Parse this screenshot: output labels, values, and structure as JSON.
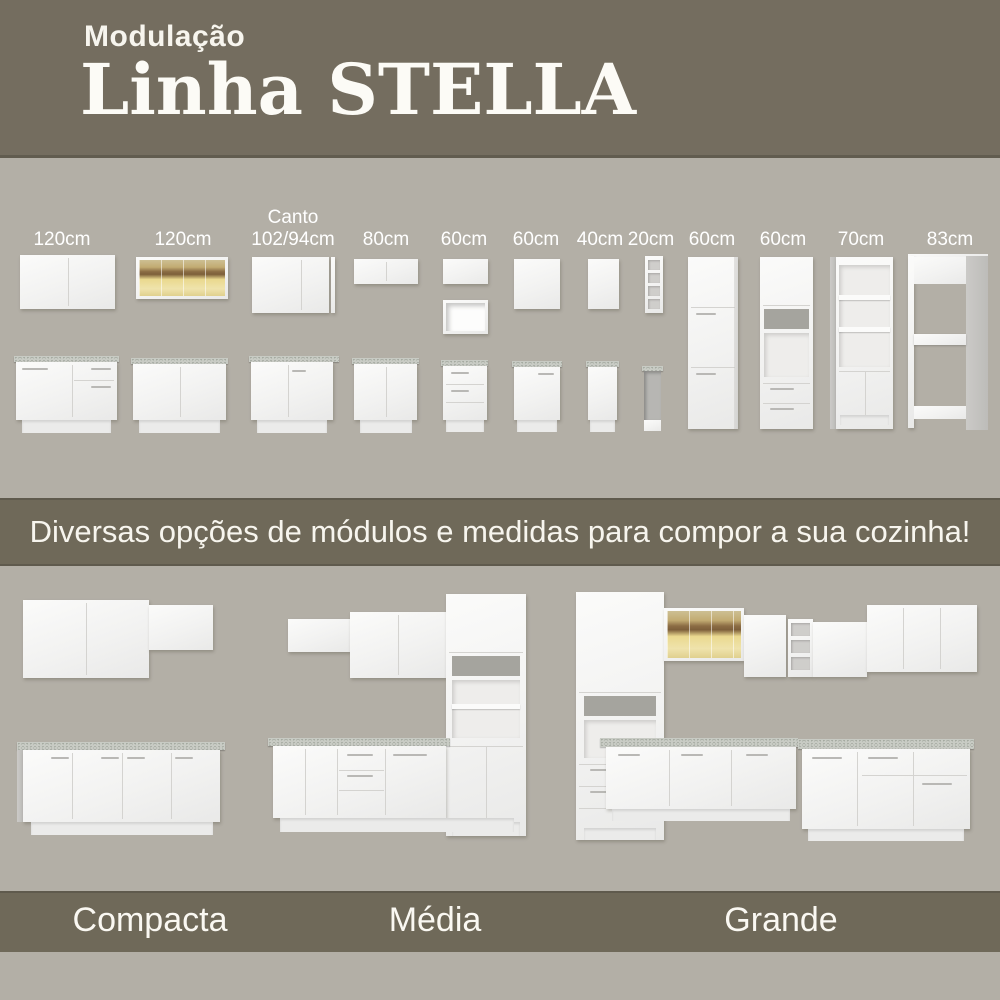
{
  "header": {
    "kicker": "Modulação",
    "title": "Linha STELLA"
  },
  "modules": {
    "labels": [
      {
        "label": "120cm"
      },
      {
        "label": "120cm"
      },
      {
        "label_top": "Canto",
        "label": "102/94cm"
      },
      {
        "label": "80cm"
      },
      {
        "label": "60cm"
      },
      {
        "label": "60cm"
      },
      {
        "label": "40cm"
      },
      {
        "label": "20cm"
      },
      {
        "label": "60cm"
      },
      {
        "label": "60cm"
      },
      {
        "label": "70cm"
      },
      {
        "label": "83cm"
      }
    ]
  },
  "banner": {
    "text": "Diversas opções de módulos e medidas para compor a sua cozinha!"
  },
  "kitchens": {
    "items": [
      {
        "label": "Compacta"
      },
      {
        "label": "Média"
      },
      {
        "label": "Grande"
      }
    ]
  },
  "colors": {
    "band_dark": "#6f6959",
    "background": "#b3afa6",
    "cabinet_white": "#f3f3f2",
    "countertop_granite": "#c8cbc4",
    "glass_amber": "#c2ab72",
    "text_light": "#f8f6ef"
  }
}
